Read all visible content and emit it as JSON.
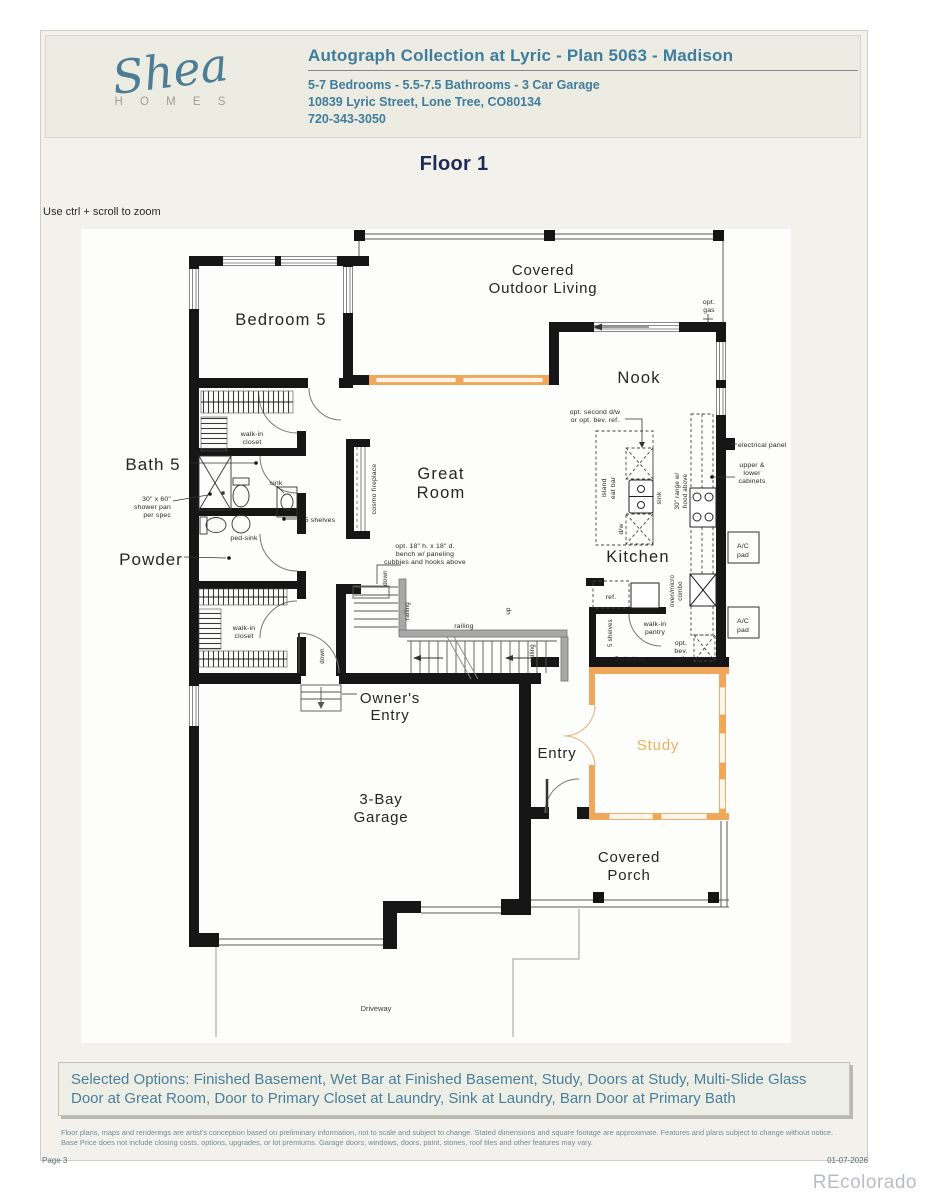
{
  "header": {
    "logo_script": "Shea",
    "logo_sub": "H O M E S",
    "title": "Autograph Collection at Lyric - Plan 5063 - Madison",
    "subtitle": "5-7 Bedrooms - 5.5-7.5 Bathrooms - 3 Car Garage",
    "address": "10839 Lyric Street, Lone Tree, CO80134",
    "phone": "720-343-3050"
  },
  "floor": {
    "heading": "Floor 1",
    "zoom_hint": "Use ctrl + scroll to zoom"
  },
  "plan": {
    "rooms": {
      "bedroom5": "Bedroom 5",
      "bath5": "Bath 5",
      "powder": "Powder",
      "great_1": "Great",
      "great_2": "Room",
      "nook": "Nook",
      "kitchen": "Kitchen",
      "owners_1": "Owner's",
      "owners_2": "Entry",
      "entry": "Entry",
      "study": "Study",
      "garage_1": "3-Bay",
      "garage_2": "Garage",
      "porch_1": "Covered",
      "porch_2": "Porch",
      "odl_1": "Covered",
      "odl_2": "Outdoor Living",
      "driveway": "Driveway"
    },
    "annotations": {
      "walk_in": "walk-in",
      "closet": "closet",
      "shower_1": "30\" x 60\"",
      "shower_2": "shower pan",
      "shower_3": "per spec",
      "sink": "sink",
      "ped_sink": "ped-sink",
      "five_shelves": "5 shelves",
      "cosmo_fireplace": "cosmo fireplace",
      "bench_1": "opt. 18\" h. x 18\" d.",
      "bench_2": "bench w/ paneling",
      "bench_3": "cubbies and hooks above",
      "railing": "railing",
      "up": "up",
      "down": "down",
      "opt_dw_1": "opt. second d/w",
      "opt_dw_2": "or opt. bev. ref.",
      "island": "island",
      "eat_bar": "eat bar",
      "dw": "d/w",
      "range_1": "30\" range w/",
      "range_2": "hood above",
      "oven_1": "oven/micro",
      "oven_2": "combo",
      "opt": "opt.",
      "bev": "bev.",
      "ref": "ref.",
      "gas": "gas",
      "pantry": "pantry",
      "electrical_panel": "electrical panel",
      "cab_1": "upper &",
      "cab_2": "lower",
      "cab_3": "cabinets",
      "ac_1": "A/C",
      "ac_2": "pad"
    }
  },
  "footer": {
    "selected_options": "Selected Options: Finished Basement, Wet Bar at Finished Basement, Study, Doors at Study, Multi-Slide Glass Door at Great Room, Door to Primary Closet at Laundry, Sink at Laundry, Barn Door at Primary Bath",
    "disclaimer": "Floor plans, maps and renderings are artist's conception based on preliminary information, not to scale and subject to change. Stated dimensions and square footage are approximate. Features and plans subject to change without notice. Base Price does not include closing costs, options, upgrades, or lot premiums. Garage doors, windows, doors, paint, stones, roof tiles and other features may vary.",
    "page": "Page 3",
    "date": "01-07-2026",
    "watermark": "REcolorado"
  },
  "colors": {
    "accent_teal": "#3f7d9e",
    "heading_navy": "#1e2c55",
    "option_orange": "#efa75a",
    "watermark_gray": "#b9bdc1"
  }
}
